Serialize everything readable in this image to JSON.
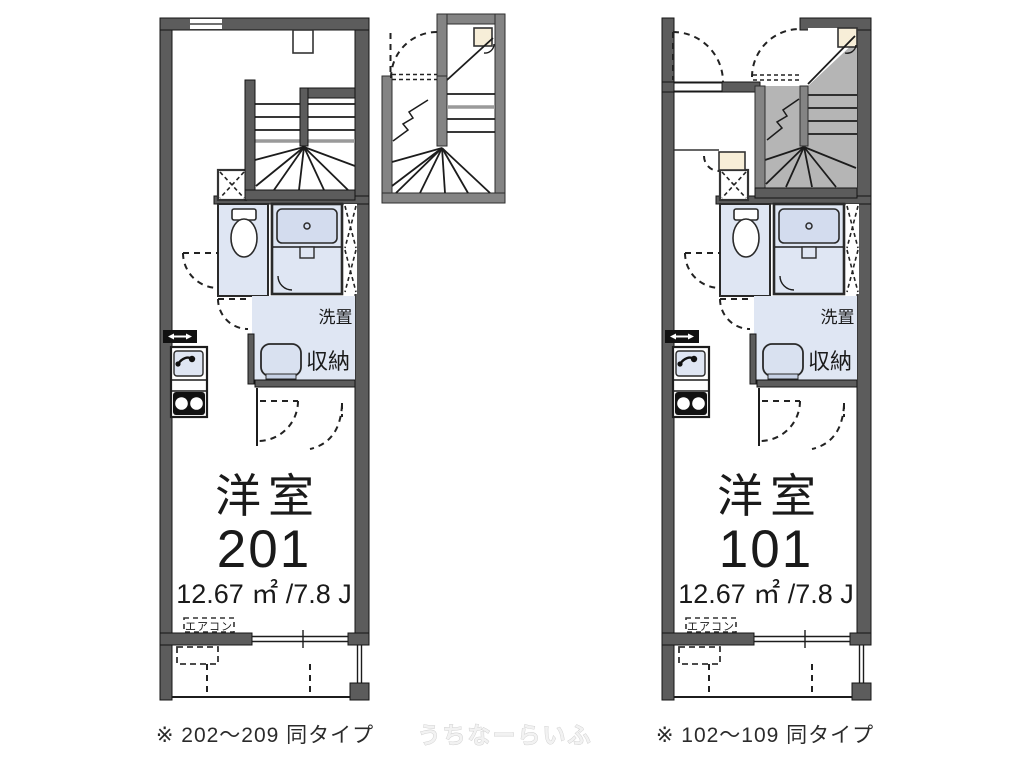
{
  "units": {
    "left": {
      "room_label": "洋室",
      "room_number": "201",
      "area": "12.67 ㎡ /7.8 J",
      "aircon_label": "エアコン",
      "laundry_label": "洗置",
      "storage_label": "収納",
      "caption": "※ 202～209 同タイプ"
    },
    "right": {
      "room_label": "洋室",
      "room_number": "101",
      "area": "12.67 ㎡ /7.8 J",
      "aircon_label": "エアコン",
      "laundry_label": "洗置",
      "storage_label": "収納",
      "caption": "※ 102～109 同タイプ"
    }
  },
  "watermark": "うちなーらいふ",
  "colors": {
    "wall_dark": "#5c5c5c",
    "wall_medium": "#848484",
    "stair_floor_gray": "#b5b5b5",
    "fixture_blue": "#dfe6f3",
    "laundry_box_blue": "#cdd7ea",
    "storage_beige": "#f7eed8",
    "background": "#ffffff"
  }
}
